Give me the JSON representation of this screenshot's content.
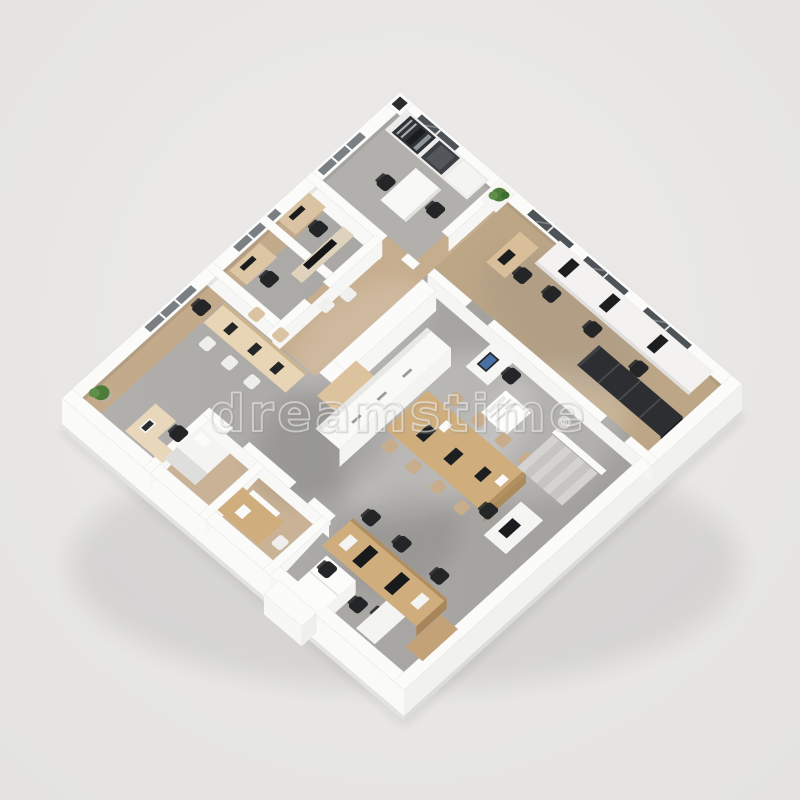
{
  "watermark": {
    "text": "dreamstime",
    "registered_mark": "®"
  },
  "palette": {
    "background": "#e8e7e5",
    "exterior_wall": "#fbfbfa",
    "floor_concrete": "#a9a7a4",
    "floor_wood": "#c2aa8b",
    "desk_wood": "#cfad7d",
    "furniture_white": "#f7f7f5",
    "chair_black": "#232527",
    "window_glass": "#4e5357",
    "plant_green": "#4d7c39",
    "screen_blue": "#4a6fa5",
    "watermark_white": "#ffffff"
  },
  "scene": {
    "description": "Isometric 3D render of a furnished office floor plan on a light gray background",
    "areas": [
      "kitchen-break-room",
      "small-office-left",
      "small-office-tv",
      "open-office-west",
      "reception-counter",
      "conference-table-area",
      "team-desk-area",
      "east-desk-row",
      "locker-row",
      "washroom-vanity",
      "rest-nook",
      "stairs",
      "storage-wardrobe"
    ]
  }
}
